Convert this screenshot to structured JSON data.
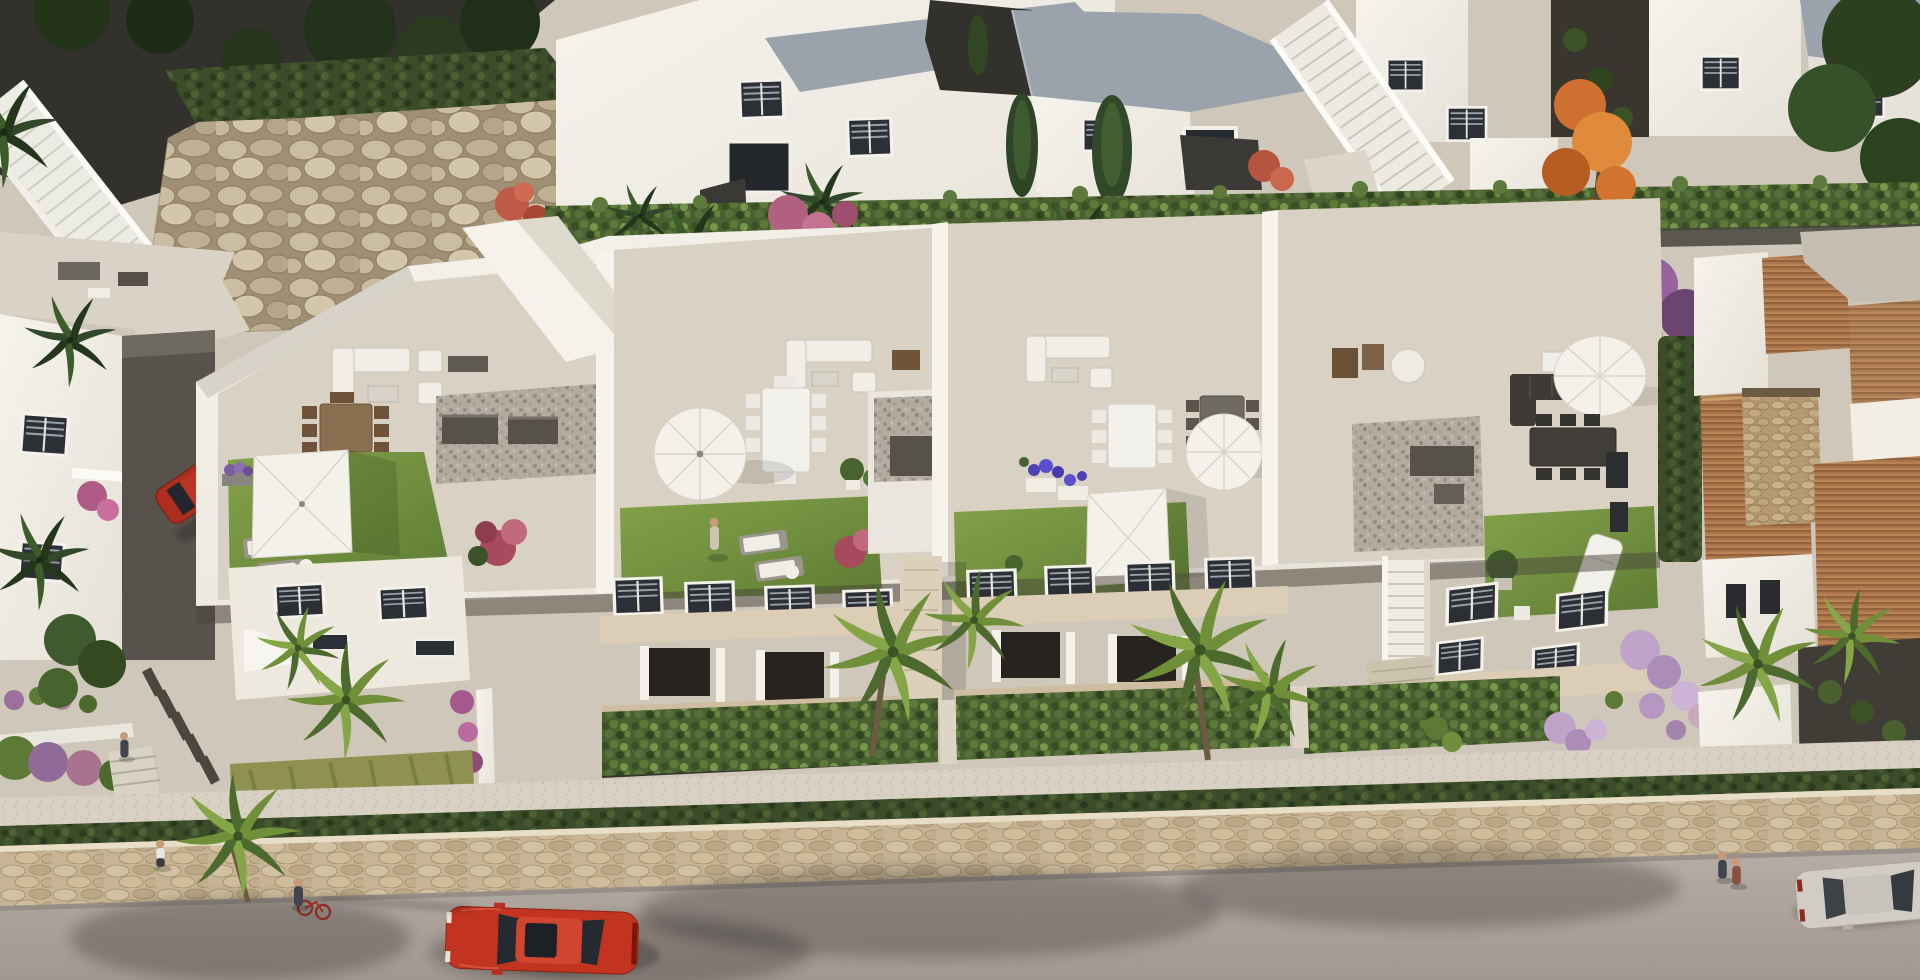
{
  "meta": {
    "type": "architectural-render",
    "description": "Aerial 3D rendering of a modern white townhouse development: a row of four units with furnished roof-top terraces (lawns, parasols, dining sets, lounge sofas), an upper row of white houses with gray pitched roofs behind a long hedge, a Mediterranean villa with clay tile roofs and a stone tower on the right, front gardens with palms and hedges, a beige stone retaining wall, and a gray street in the foreground with cars and pedestrians."
  },
  "palette": {
    "white_lit": "#f3f0e9",
    "white_mid": "#e9e5dc",
    "white_shade": "#d6d1c6",
    "tile_floor": "#d9d1c3",
    "road": "#afa69f",
    "stone_wall": "#c7b495",
    "sidewalk": "#d8d0c2",
    "hedge": "#56733a",
    "hedge_dark": "#3d4d2a",
    "lawn": "#6f9038",
    "gravel": "#3b3935",
    "roof_gray": "#9aa2ac",
    "clay": "#a9754a",
    "parasol": "#f4f1ea",
    "wood": "#8a6e50",
    "charcoal": "#3e3b37",
    "car_red": "#c23420",
    "car_silver": "#d2cdc4",
    "hatch_red": "#ad2d1e",
    "orange_tree": "#cf7030",
    "purple": "#8a5a90",
    "lavender": "#bfa3c9",
    "pink": "#b05268",
    "blue_flower": "#4c42b4",
    "coral": "#c05a48",
    "skin": "#c89b78",
    "pebble": "#b3aba0",
    "soil": "#35332c",
    "path_light": "#ddd5c6",
    "wood_floor": "#cfbda2",
    "glass": "#262a31",
    "stair_tile": "#dcd0ba"
  },
  "scene": {
    "upper_row": {
      "houses": 5,
      "features": [
        "gray pitched roofs",
        "white walls with shuttered windows",
        "dark gravel courtyards",
        "long trimmed hedge",
        "cypress trees",
        "banana palms",
        "orange flowering tree",
        "two white exterior staircases",
        "natural rock retaining wall"
      ]
    },
    "terrace_block": {
      "units": 4,
      "terraces": [
        {
          "id": 1,
          "items": [
            "white lounge set",
            "timber dining table with eight chairs",
            "square white parasol",
            "lawn",
            "two sun loungers",
            "pink shrub",
            "pebble patio with AC units"
          ]
        },
        {
          "id": 2,
          "items": [
            "round white parasol",
            "long white dining table",
            "lawn with person standing",
            "two sun loungers",
            "pink shrub",
            "potted plants",
            "white lounge set"
          ]
        },
        {
          "id": 3,
          "items": [
            "white dining table",
            "gray dining set",
            "round white parasol",
            "square white parasol on lawn",
            "planters with violet flowers",
            "white lounge set"
          ]
        },
        {
          "id": 4,
          "items": [
            "charcoal corner sofa",
            "round white parasol",
            "dark dining table with six chairs",
            "lawn",
            "white sun lounger",
            "potted plant",
            "pebble patio with AC unit"
          ]
        }
      ]
    },
    "villa": {
      "features": [
        "clay tile roofs",
        "stone-clad tower",
        "white gable",
        "gravel courtyard",
        "lavender ball shrubs",
        "white gate"
      ]
    },
    "street": {
      "bands": [
        "front gardens with bright hedges and palms",
        "light walkway",
        "low dark hedge",
        "beige stone retaining wall",
        "gray asphalt road"
      ],
      "cars": [
        {
          "name": "red-sedan",
          "color": "#c23420",
          "state": "driving on road"
        },
        {
          "name": "silver-sedan",
          "color": "#d2cdc4",
          "state": "at right edge of road"
        },
        {
          "name": "red-hatchback",
          "color": "#ad2d1e",
          "state": "parked in side alley"
        }
      ],
      "pedestrians": 6
    }
  }
}
